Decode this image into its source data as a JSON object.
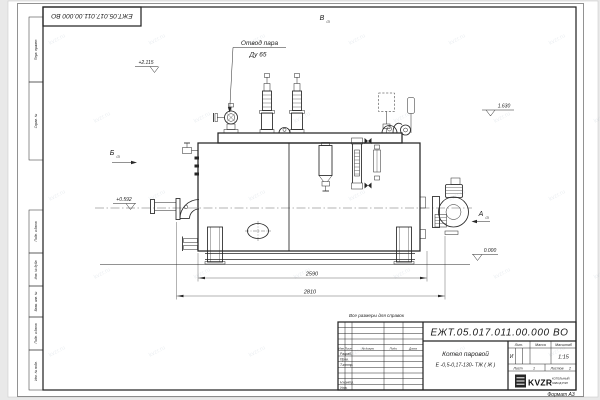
{
  "sheet": {
    "top_stamp": "ЕЖТ.05.017.011.00.000  ВО",
    "side_labels": [
      "Перв. примен.",
      "Справ. №",
      "Подп. и дата",
      "Инв. № дубл.",
      "Взам. инв. №",
      "Подп. и дата",
      "Инв. № подл."
    ],
    "format_note": "Формат А3"
  },
  "drawing": {
    "callout_line1": "Отвод пара",
    "callout_line2": "Ду 65",
    "view_a": "А",
    "view_b": "Б",
    "view_v": "В",
    "view_ref": "(2)",
    "elev_valves": "+2.115",
    "elev_inlet": "+0.592",
    "elev_right": "1.630",
    "elev_ground": "0.000",
    "dim_inner": "2590",
    "dim_outer": "2810"
  },
  "title_block": {
    "note": "Все размеры для справок",
    "doc_number": "ЕЖТ.05.017.011.00.000  ВО",
    "product_line1": "Котел паровой",
    "product_line2": "Е -0,5-0,17-130- ТЖ ( Ж )",
    "col_izm": "Изм.",
    "col_list": "Лист",
    "col_doc": "№ докум.",
    "col_sign": "Подп.",
    "col_date": "Дата",
    "row_razrab": "Разраб.",
    "row_prov": "Пров.",
    "row_tkontr": "Т.контр.",
    "row_nkontr": "Н.контр.",
    "row_utv": "Утв.",
    "lit_header": "Лит.",
    "lit_value": "И",
    "mass_header": "Масса",
    "scale_header": "Масштаб",
    "scale_value": "1:15",
    "sheet_label": "Лист",
    "sheet_value": "1",
    "sheets_label": "Листов",
    "sheets_value": "2",
    "company": "KVZR",
    "company_line1": "КОТЕЛЬНЫЙ",
    "company_line2": "ЗАВОД РЭП"
  },
  "watermark": {
    "text": "kvzr.ru"
  }
}
